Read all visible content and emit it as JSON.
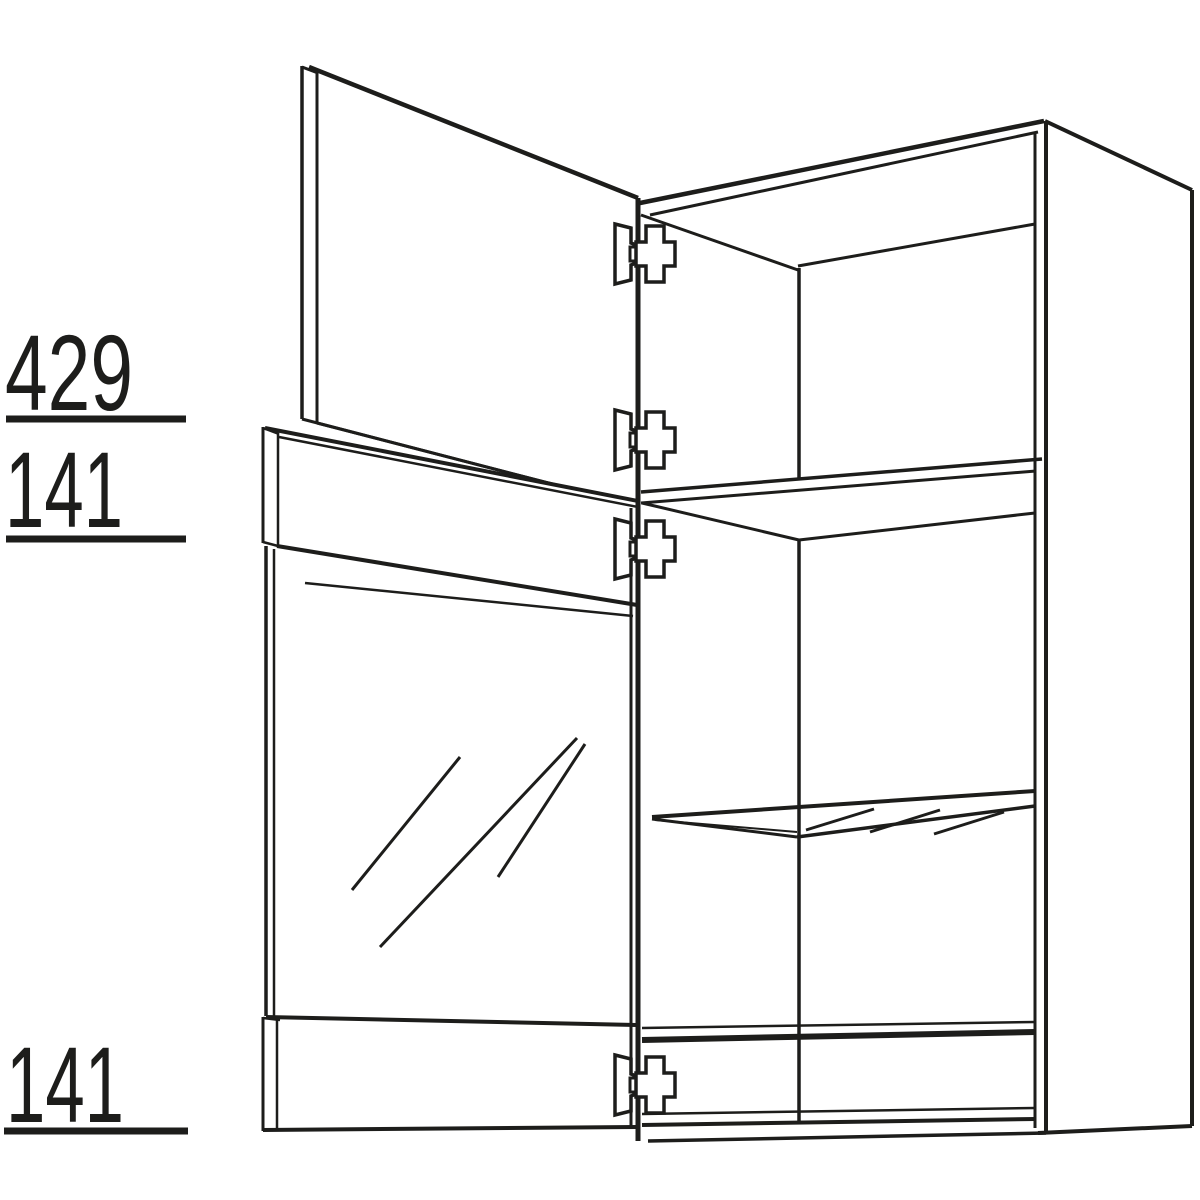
{
  "page": {
    "background": "#ffffff"
  },
  "drawing": {
    "stroke_color": "#1d1d1b",
    "dimension_labels": {
      "top_door": "429",
      "top_rail": "141",
      "bottom_rail": "141"
    },
    "parts": {
      "hinge_count": 4
    }
  }
}
